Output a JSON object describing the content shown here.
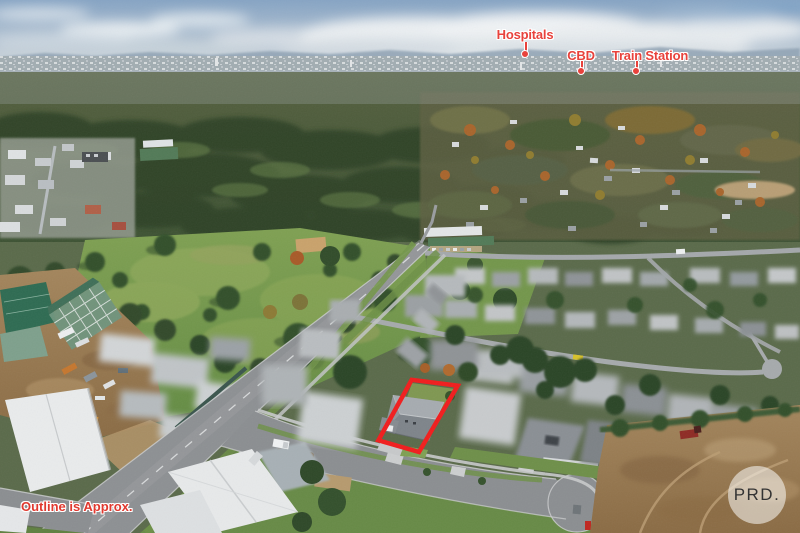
{
  "annotations": {
    "hospitals_label": "Hospitals",
    "cbd_label": "CBD",
    "train_station_label": "Train Station",
    "disclaimer": "Outline is Approx."
  },
  "logo": {
    "text": "PRD."
  },
  "colors": {
    "annotation_red": "#e8423c",
    "property_outline_red": "#f11d1d",
    "logo_text": "#333333",
    "logo_background": "#ffffff"
  }
}
